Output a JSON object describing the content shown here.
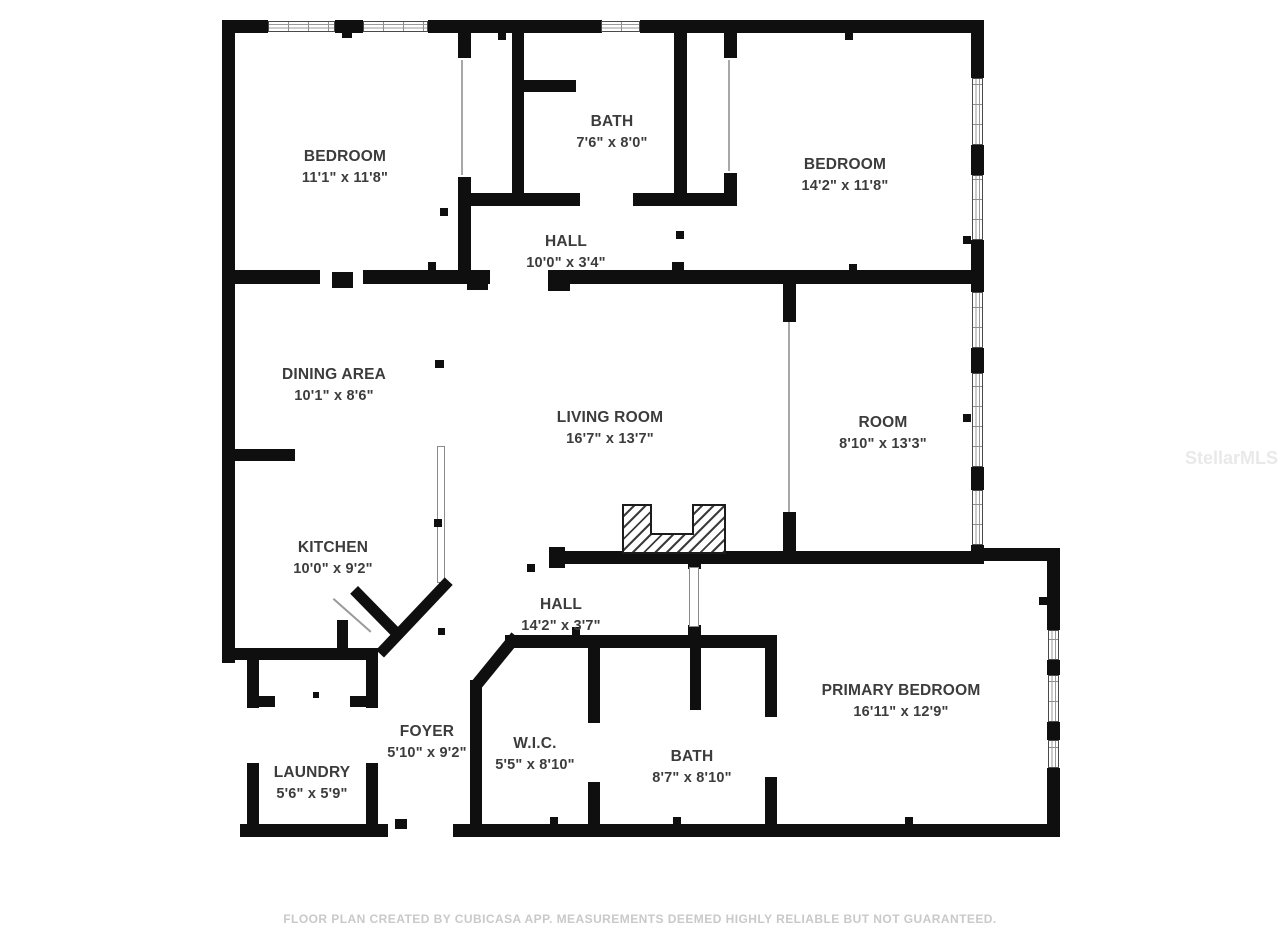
{
  "plan": {
    "rooms": [
      {
        "name": "BEDROOM",
        "dims": "11'1\" x 11'8\""
      },
      {
        "name": "BATH",
        "dims": "7'6\" x 8'0\""
      },
      {
        "name": "BEDROOM",
        "dims": "14'2\" x 11'8\""
      },
      {
        "name": "HALL",
        "dims": "10'0\" x 3'4\""
      },
      {
        "name": "DINING AREA",
        "dims": "10'1\" x 8'6\""
      },
      {
        "name": "LIVING ROOM",
        "dims": "16'7\" x 13'7\""
      },
      {
        "name": "ROOM",
        "dims": "8'10\" x 13'3\""
      },
      {
        "name": "KITCHEN",
        "dims": "10'0\" x 9'2\""
      },
      {
        "name": "HALL",
        "dims": "14'2\" x 3'7\""
      },
      {
        "name": "FOYER",
        "dims": "5'10\" x 9'2\""
      },
      {
        "name": "W.I.C.",
        "dims": "5'5\" x 8'10\""
      },
      {
        "name": "BATH",
        "dims": "8'7\" x 8'10\""
      },
      {
        "name": "PRIMARY BEDROOM",
        "dims": "16'11\" x 12'9\""
      },
      {
        "name": "LAUNDRY",
        "dims": "5'6\" x 5'9\""
      }
    ],
    "footer": "FLOOR PLAN CREATED BY CUBICASA APP. MEASUREMENTS DEEMED HIGHLY RELIABLE BUT NOT GUARANTEED.",
    "watermark": "StellarMLS",
    "colors": {
      "wall": "#0f0f0f",
      "label": "#3c3c3c",
      "footer_text": "#c9c9c9",
      "watermark_text": "#e9e9e9"
    }
  }
}
